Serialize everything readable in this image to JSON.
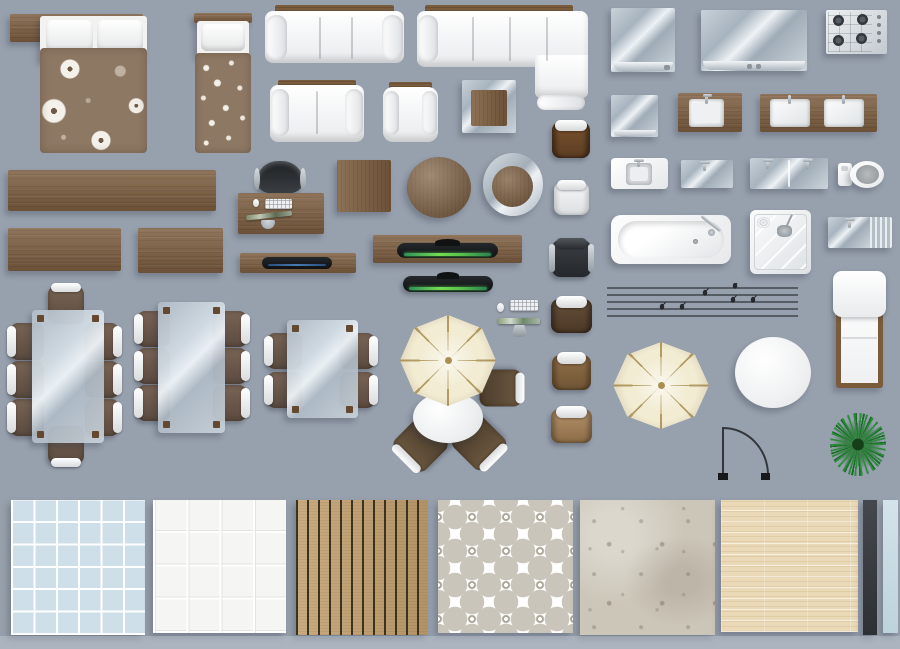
{
  "canvas": {
    "width": 900,
    "height": 649,
    "background": "#97a0ad",
    "bottom_band": "#b6c1ca"
  },
  "palette": {
    "wood": "#7d5e40",
    "wood_dark": "#64492f",
    "fabric_brown": "#8d7863",
    "upholstery_white": "#f4f5f6",
    "glass": "#c6d0d7",
    "umbrella_canvas": "#f2ecd3",
    "umbrella_rib": "#b39c63",
    "tv_glow_green": "#58c24a",
    "media_blue": "#4a7ab1",
    "plant_green": "#2c8c3c",
    "tile_blue": "#cfdfe9",
    "deck_wood": "#c2a06e",
    "parquet": "#ead9b6",
    "concrete": "#ccc6b8",
    "strip_dark": "#3a3d43",
    "strip_blue": "#c9dde4"
  },
  "inventory": {
    "description": "Top-view furniture and texture set for floor plans",
    "items": [
      {
        "label": "Double bed"
      },
      {
        "label": "Single bed"
      },
      {
        "label": "Three-seat sofa"
      },
      {
        "label": "Corner sofa"
      },
      {
        "label": "Two-seat sofa"
      },
      {
        "label": "Armchair"
      },
      {
        "label": "Glass side table"
      },
      {
        "label": "Appliance top (small)"
      },
      {
        "label": "Appliance top (wide)"
      },
      {
        "label": "Gas cooktop"
      },
      {
        "label": "Glass panel"
      },
      {
        "label": "Kitchen sink"
      },
      {
        "label": "Double kitchen sink"
      },
      {
        "label": "Long sideboard"
      },
      {
        "label": "Sideboard"
      },
      {
        "label": "Wood board"
      },
      {
        "label": "Office chair"
      },
      {
        "label": "Office desk"
      },
      {
        "label": "Square coffee table"
      },
      {
        "label": "Round coffee table"
      },
      {
        "label": "Round glass-rim table"
      },
      {
        "label": "Leather chair"
      },
      {
        "label": "White chair"
      },
      {
        "label": "Black chair"
      },
      {
        "label": "Dark wood chair"
      },
      {
        "label": "Wood chair"
      },
      {
        "label": "Light wood chair"
      },
      {
        "label": "Media shelf"
      },
      {
        "label": "TV console"
      },
      {
        "label": "Flat TV"
      },
      {
        "label": "Computer mouse"
      },
      {
        "label": "Computer keyboard"
      },
      {
        "label": "TV on stand"
      },
      {
        "label": "Dining set - 8 seats"
      },
      {
        "label": "Dining set - 6 seats"
      },
      {
        "label": "Dining set - 4 seats"
      },
      {
        "label": "Patio set with umbrella"
      },
      {
        "label": "Parasol"
      },
      {
        "label": "Wires with birds"
      },
      {
        "label": "Bathroom sink unit"
      },
      {
        "label": "Glass washbasin"
      },
      {
        "label": "Double glass washbasin"
      },
      {
        "label": "Toilet"
      },
      {
        "label": "Bathtub"
      },
      {
        "label": "Shower cabin"
      },
      {
        "label": "Utility sink with drainboard"
      },
      {
        "label": "Chaise lounge"
      },
      {
        "label": "Round white table"
      },
      {
        "label": "Door swing symbol"
      },
      {
        "label": "Potted plant"
      },
      {
        "label": "Blue tile texture"
      },
      {
        "label": "White tile texture"
      },
      {
        "label": "Wood deck texture"
      },
      {
        "label": "Ornament tile texture"
      },
      {
        "label": "Concrete texture"
      },
      {
        "label": "Light parquet texture"
      },
      {
        "label": "Dark strip"
      },
      {
        "label": "Blue strip"
      }
    ]
  }
}
